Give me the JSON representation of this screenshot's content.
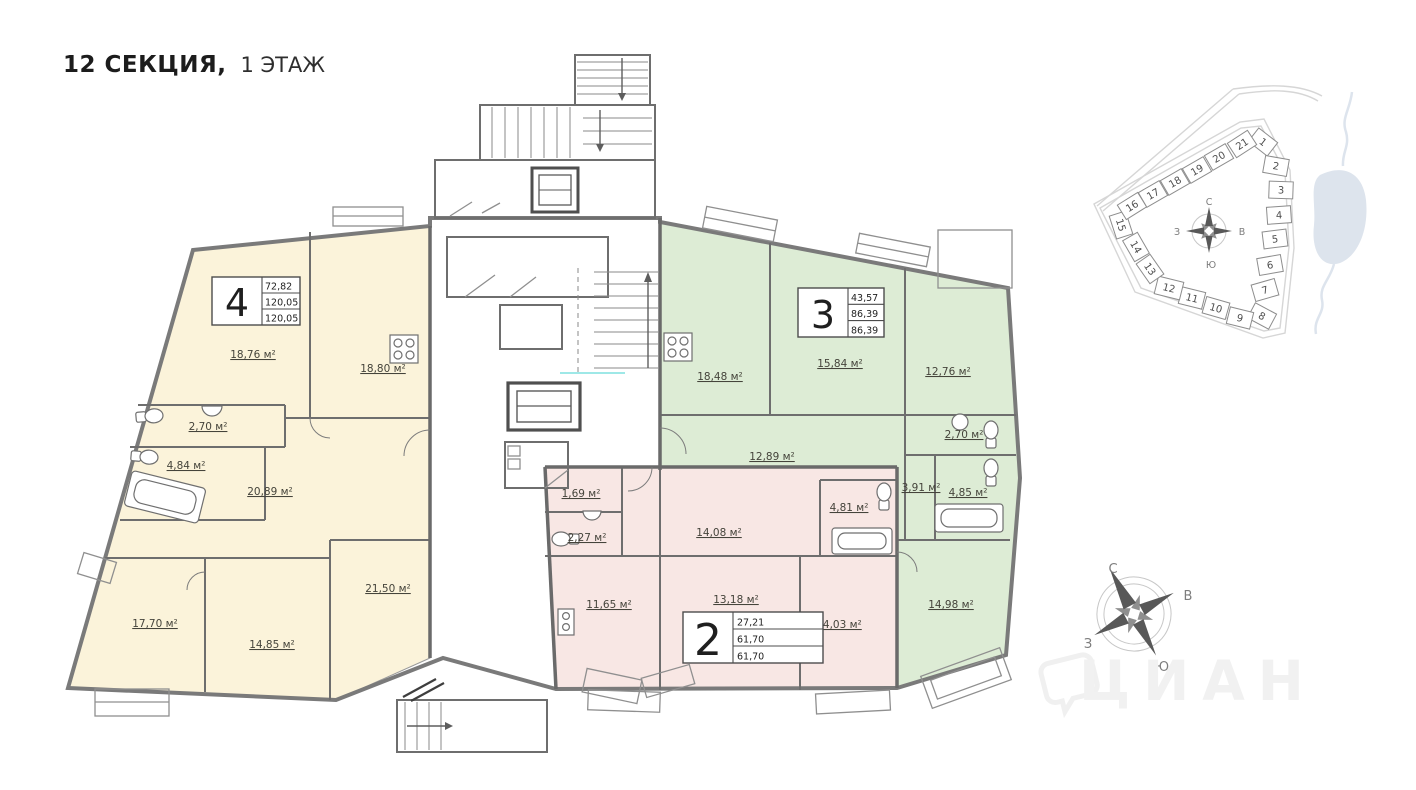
{
  "header": {
    "section_title": "12 СЕКЦИЯ,",
    "floor_title": "1 ЭТАЖ"
  },
  "apartments": [
    {
      "id": "4",
      "number": "4",
      "stats": [
        "72,82",
        "120,05",
        "120,05"
      ],
      "rooms": [
        "18,76 м²",
        "18,80 м²",
        "2,70 м²",
        "4,84 м²",
        "20,89 м²",
        "21,50 м²",
        "17,70 м²",
        "14,85 м²"
      ]
    },
    {
      "id": "3",
      "number": "3",
      "stats": [
        "43,57",
        "86,39",
        "86,39"
      ],
      "rooms": [
        "18,48 м²",
        "15,84 м²",
        "12,76 м²",
        "12,89 м²",
        "2,70 м²",
        "3,91 м²",
        "4,85 м²",
        "14,98 м²"
      ]
    },
    {
      "id": "2",
      "number": "2",
      "stats": [
        "27,21",
        "61,70",
        "61,70"
      ],
      "rooms": [
        "1,69 м²",
        "2,27 м²",
        "11,65 м²",
        "14,08 м²",
        "13,18 м²",
        "4,81 м²",
        "14,03 м²"
      ]
    }
  ],
  "siteplan": {
    "sections": [
      "1",
      "2",
      "3",
      "4",
      "5",
      "6",
      "7",
      "8",
      "9",
      "10",
      "11",
      "12",
      "13",
      "14",
      "15",
      "16",
      "17",
      "18",
      "19",
      "20",
      "21"
    ],
    "highlighted_section": "12",
    "compass": {
      "north": "С",
      "south": "Ю",
      "west": "З",
      "east": "В"
    }
  },
  "compass": {
    "north": "С",
    "south": "Ю",
    "west": "З",
    "east": "В"
  },
  "watermark": {
    "brand": "ЦИАН"
  },
  "colors": {
    "apartment_4_fill": "#fbf3da",
    "apartment_3_fill": "#ddecd5",
    "apartment_2_fill": "#f8e7e4",
    "section_highlight": "#c9c9c9",
    "water": "#dde4ed"
  }
}
